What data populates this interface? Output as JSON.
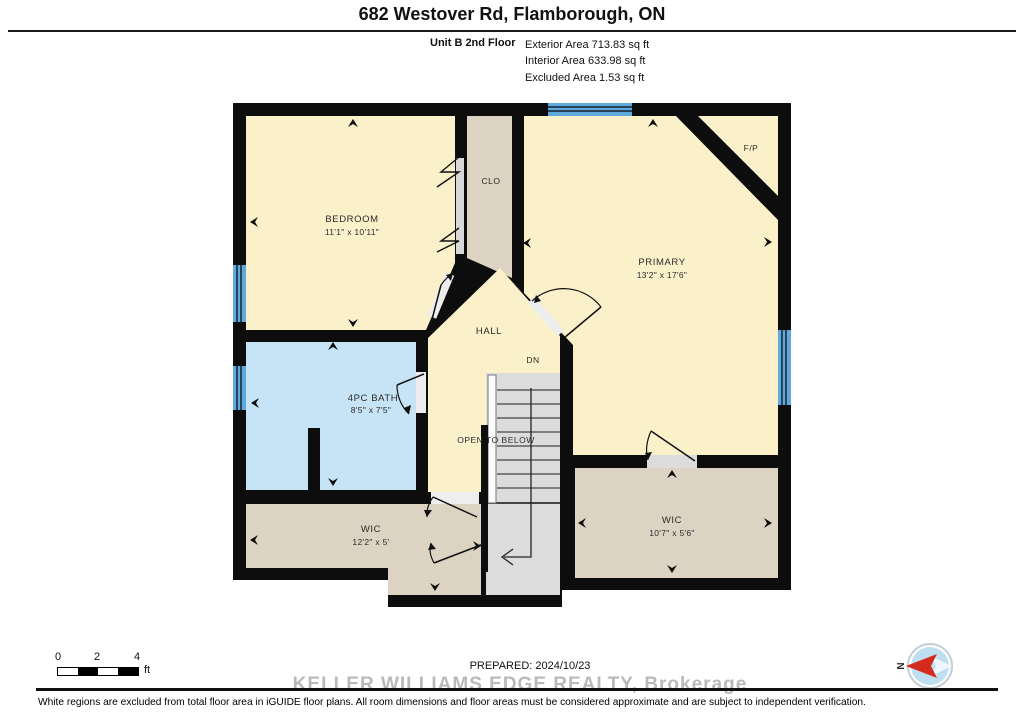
{
  "header": {
    "title": "682 Westover Rd, Flamborough, ON",
    "unit_label": "Unit B 2nd Floor",
    "area_lines": [
      "Exterior Area 713.83 sq ft",
      "Interior Area 633.98 sq ft",
      "Excluded Area 1.53 sq ft"
    ]
  },
  "plan": {
    "rooms": [
      {
        "name": "BEDROOM",
        "dims": "11'1\" x 10'11\""
      },
      {
        "name": "CLO",
        "dims": ""
      },
      {
        "name": "PRIMARY",
        "dims": "13'2\" x 17'6\""
      },
      {
        "name": "HALL",
        "dims": ""
      },
      {
        "name": "4PC BATH",
        "dims": "8'5\" x 7'5\""
      },
      {
        "name": "WIC",
        "dims": "12'2\" x 5'"
      },
      {
        "name": "WIC",
        "dims": "10'7\" x 5'6\""
      }
    ],
    "labels": {
      "fireplace": "F/P",
      "stairs_down": "DN",
      "open_below": "OPEN TO BELOW"
    },
    "colors": {
      "room_cream": "#FAF0CA",
      "closet_tan": "#DCD3C3",
      "bath_blue": "#C6E4F5",
      "stairs_gray": "#DCDCDC",
      "wall_black": "#0d0d0d",
      "window_blue": "#5FA9DC",
      "compass_red": "#D42B1E"
    }
  },
  "footer": {
    "scale": {
      "ticks": [
        "0",
        "2",
        "4"
      ],
      "unit": "ft"
    },
    "prepared": "PREPARED: 2024/10/23",
    "watermark": "KELLER WILLIAMS EDGE REALTY, Brokerage",
    "disclaimer": "White regions are excluded from total floor area in iGUIDE floor plans. All room dimensions and floor areas must be considered approximate and are subject to independent verification.",
    "compass_n": "N"
  }
}
